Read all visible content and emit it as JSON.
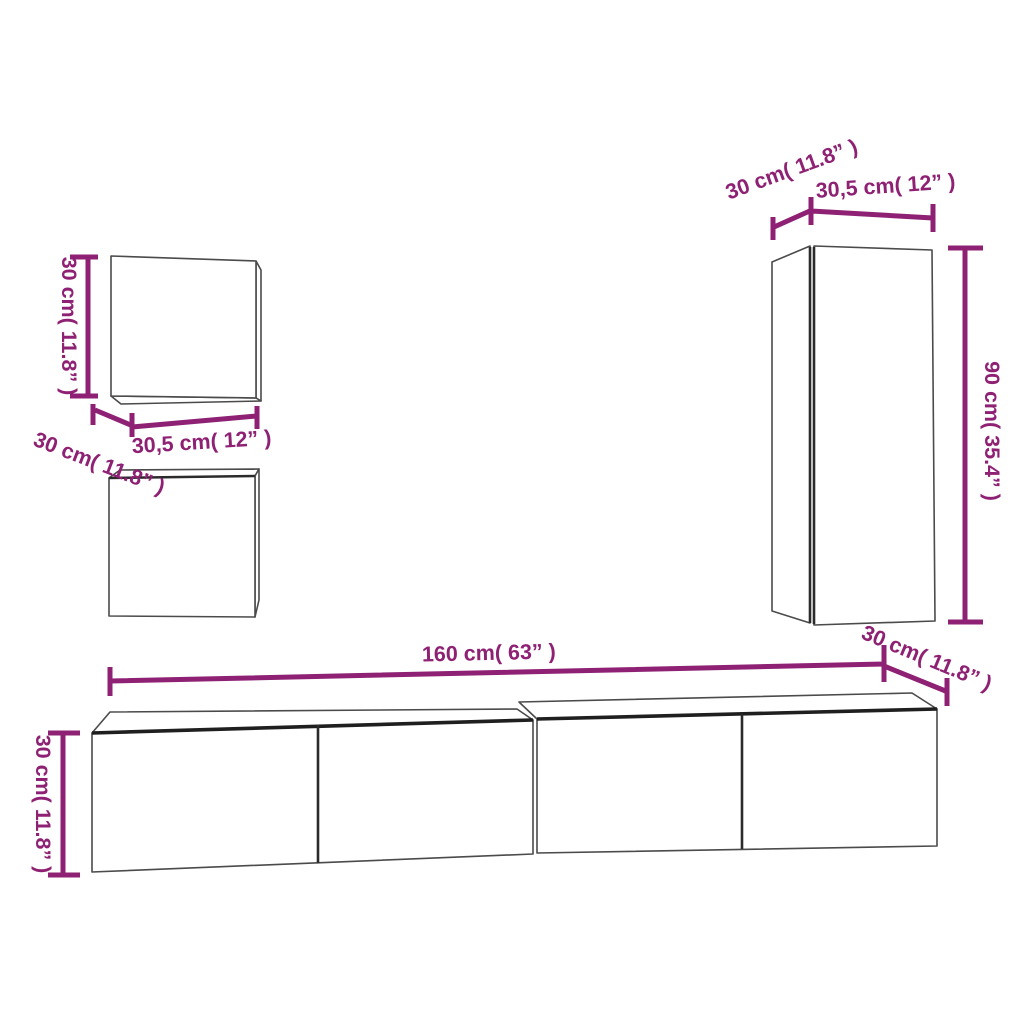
{
  "colors": {
    "dimension": "#8e2173",
    "outline": "#4b4b4b",
    "outline_dark": "#1f1f1f",
    "background": "#ffffff"
  },
  "labels": {
    "small_cab_height": "30 cm( 11.8” )",
    "small_cab_depth": "30 cm( 11.8” )",
    "small_cab_width": "30,5 cm( 12” )",
    "tall_cab_depth": "30 cm( 11.8” )",
    "tall_cab_width": "30,5 cm( 12” )",
    "tall_cab_height": "90 cm( 35.4” )",
    "tall_cab_bottom_depth": "30 cm( 11.8” )",
    "tv_stand_width": "160 cm( 63” )",
    "tv_stand_height": "30 cm( 11.8” )"
  }
}
